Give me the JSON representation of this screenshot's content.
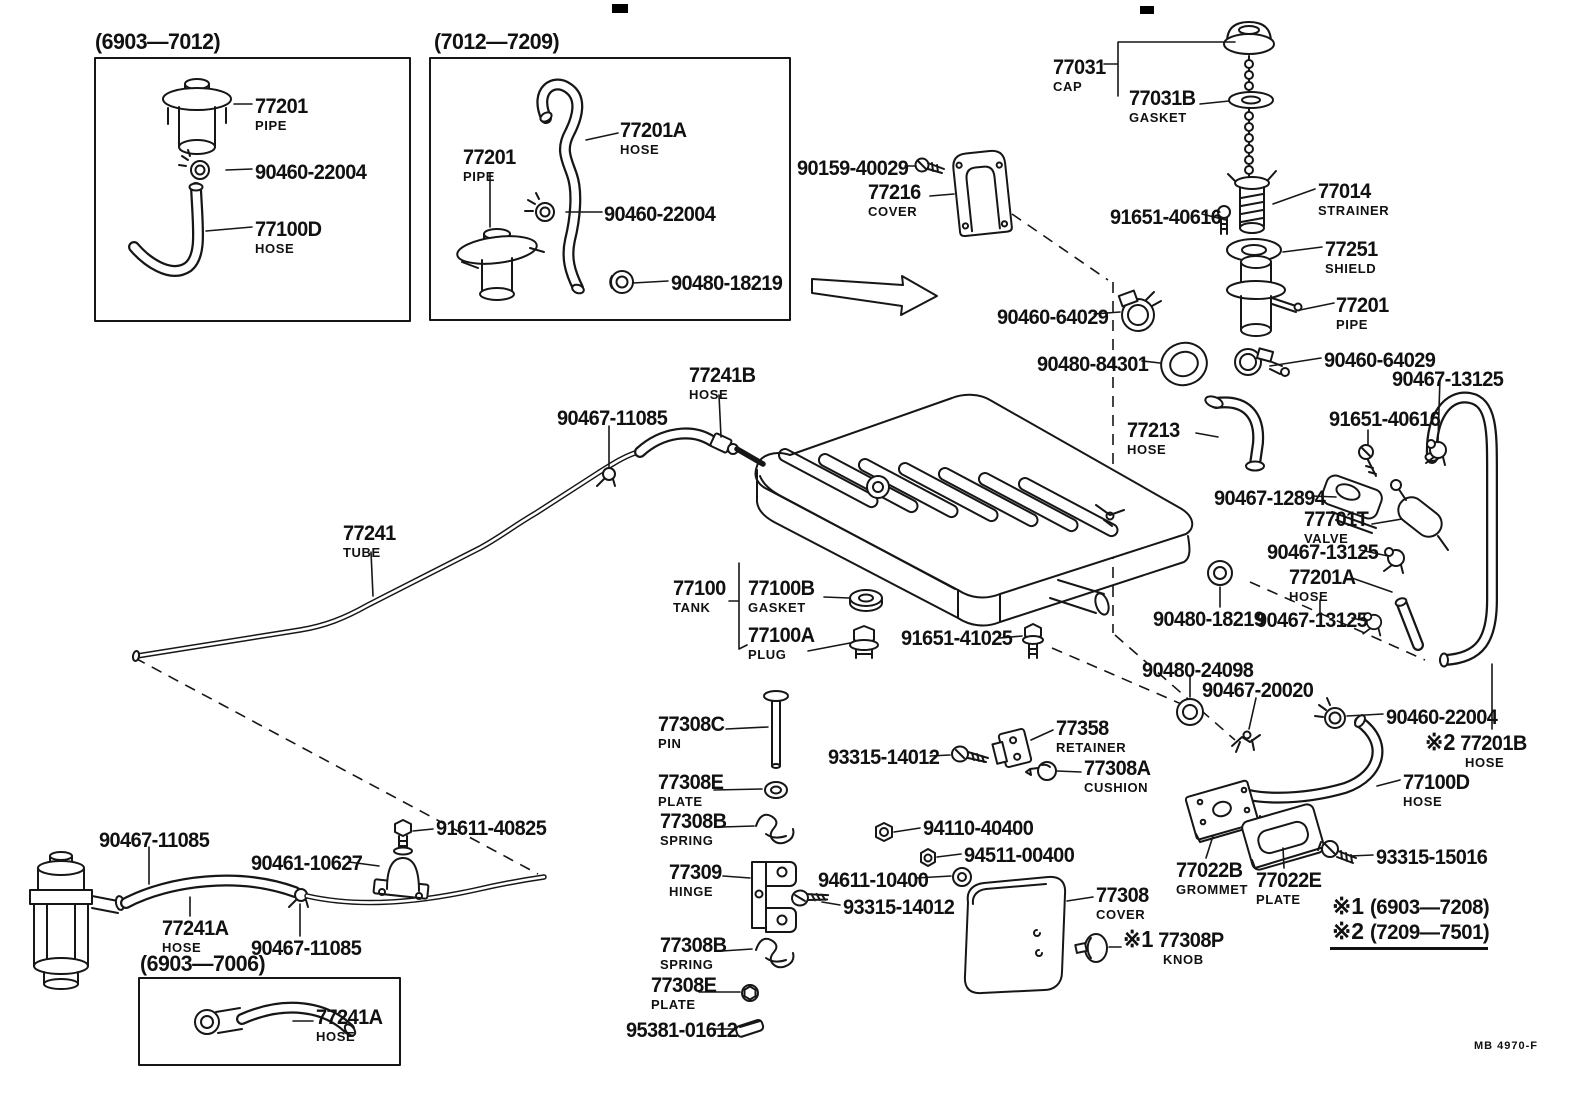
{
  "doc": {
    "stamp": "MB 4970-F"
  },
  "insets": {
    "a_period": "(6903—7012)",
    "b_period": "(7012—7209)",
    "c_period": "(6903—7006)"
  },
  "notes": {
    "n1_prefix": "※1",
    "n1_text": "(6903—7208)",
    "n2_prefix": "※2",
    "n2_text": "(7209—7501)"
  },
  "callouts": [
    {
      "id": "pipe-early",
      "code": "77201",
      "name": "PIPE",
      "x": 255,
      "y": 96
    },
    {
      "id": "clamp-early",
      "code": "90460-22004",
      "x": 255,
      "y": 162
    },
    {
      "id": "hose-early",
      "code": "77100D",
      "name": "HOSE",
      "x": 255,
      "y": 219
    },
    {
      "id": "hose-mid",
      "code": "77201A",
      "name": "HOSE",
      "x": 620,
      "y": 120
    },
    {
      "id": "pipe-mid",
      "code": "77201",
      "name": "PIPE",
      "x": 463,
      "y": 147
    },
    {
      "id": "clamp-mid",
      "code": "90460-22004",
      "x": 604,
      "y": 204
    },
    {
      "id": "grommet-mid",
      "code": "90480-18219",
      "x": 671,
      "y": 273
    },
    {
      "id": "fuel-cap",
      "code": "77031",
      "name": "CAP",
      "x": 1053,
      "y": 57
    },
    {
      "id": "cap-gasket",
      "code": "77031B",
      "name": "GASKET",
      "x": 1129,
      "y": 88
    },
    {
      "id": "screw-cover",
      "code": "90159-40029",
      "x": 797,
      "y": 158
    },
    {
      "id": "filler-cover",
      "code": "77216",
      "name": "COVER",
      "x": 868,
      "y": 182
    },
    {
      "id": "strainer",
      "code": "77014",
      "name": "STRAINER",
      "x": 1318,
      "y": 181
    },
    {
      "id": "bolt-strainer",
      "code": "91651-40616",
      "x": 1110,
      "y": 207
    },
    {
      "id": "shield",
      "code": "77251",
      "name": "SHIELD",
      "x": 1325,
      "y": 239
    },
    {
      "id": "pipe-tank",
      "code": "77201",
      "name": "PIPE",
      "x": 1336,
      "y": 295
    },
    {
      "id": "clamp-filler-left",
      "code": "90460-64029",
      "x": 997,
      "y": 307
    },
    {
      "id": "ring-filler",
      "code": "90480-84301",
      "x": 1037,
      "y": 354
    },
    {
      "id": "clamp-filler-right",
      "code": "90460-64029",
      "x": 1324,
      "y": 350
    },
    {
      "id": "clip-top",
      "code": "90467-13125",
      "x": 1392,
      "y": 369
    },
    {
      "id": "bolt-valve",
      "code": "91651-40616",
      "x": 1329,
      "y": 409
    },
    {
      "id": "filler-hose",
      "code": "77213",
      "name": "HOSE",
      "x": 1127,
      "y": 420
    },
    {
      "id": "valve-retainer",
      "code": "90467-12894",
      "x": 1214,
      "y": 488
    },
    {
      "id": "check-valve",
      "code": "77701T",
      "name": "VALVE",
      "x": 1304,
      "y": 509
    },
    {
      "id": "clip-mid",
      "code": "90467-13125",
      "x": 1267,
      "y": 542
    },
    {
      "id": "valve-hose",
      "code": "77201A",
      "name": "HOSE",
      "x": 1289,
      "y": 567
    },
    {
      "id": "grommet-tank",
      "code": "90480-18219",
      "x": 1153,
      "y": 609
    },
    {
      "id": "clip-low",
      "code": "90467-13125",
      "x": 1256,
      "y": 610
    },
    {
      "id": "grommet-breather",
      "code": "90480-24098",
      "x": 1142,
      "y": 660
    },
    {
      "id": "clip-breather",
      "code": "90467-20020",
      "x": 1202,
      "y": 680
    },
    {
      "id": "clamp-breather",
      "code": "90460-22004",
      "x": 1386,
      "y": 707
    },
    {
      "id": "hose-late",
      "prefix": "※2",
      "code": "77201B",
      "name": "HOSE",
      "x": 1425,
      "y": 731
    },
    {
      "id": "hose-bottom",
      "code": "77100D",
      "name": "HOSE",
      "x": 1403,
      "y": 772
    },
    {
      "id": "grommet-plate",
      "code": "77022B",
      "name": "GROMMET",
      "x": 1176,
      "y": 860
    },
    {
      "id": "plate-grommet",
      "code": "77022E",
      "name": "PLATE",
      "x": 1256,
      "y": 870
    },
    {
      "id": "screw-plate",
      "code": "93315-15016",
      "x": 1376,
      "y": 847
    },
    {
      "id": "tube-hose",
      "code": "77241B",
      "name": "HOSE",
      "x": 689,
      "y": 365
    },
    {
      "id": "clip-tube",
      "code": "90467-11085",
      "x": 557,
      "y": 408
    },
    {
      "id": "fuel-tube",
      "code": "77241",
      "name": "TUBE",
      "x": 343,
      "y": 523
    },
    {
      "id": "fuel-tank",
      "code": "77100",
      "name": "TANK",
      "x": 673,
      "y": 578
    },
    {
      "id": "tank-gasket",
      "code": "77100B",
      "name": "GASKET",
      "x": 748,
      "y": 578
    },
    {
      "id": "tank-plug",
      "code": "77100A",
      "name": "PLUG",
      "x": 748,
      "y": 625
    },
    {
      "id": "drain-bolt",
      "code": "91651-41025",
      "x": 901,
      "y": 628
    },
    {
      "id": "cover-pin",
      "code": "77308C",
      "name": "PIN",
      "x": 658,
      "y": 714
    },
    {
      "id": "cover-plate-1",
      "code": "77308E",
      "name": "PLATE",
      "x": 658,
      "y": 772
    },
    {
      "id": "cover-spring-1",
      "code": "77308B",
      "name": "SPRING",
      "x": 660,
      "y": 811
    },
    {
      "id": "screw-retainer",
      "code": "93315-14012",
      "x": 828,
      "y": 747
    },
    {
      "id": "cover-retainer",
      "code": "77358",
      "name": "RETAINER",
      "x": 1056,
      "y": 718
    },
    {
      "id": "cover-cushion",
      "code": "77308A",
      "name": "CUSHION",
      "x": 1084,
      "y": 758
    },
    {
      "id": "nut-1",
      "code": "94110-40400",
      "x": 923,
      "y": 818
    },
    {
      "id": "nut-2",
      "code": "94511-00400",
      "x": 964,
      "y": 845
    },
    {
      "id": "washer",
      "code": "94611-10400",
      "x": 818,
      "y": 870
    },
    {
      "id": "cover-hinge",
      "code": "77309",
      "name": "HINGE",
      "x": 669,
      "y": 862
    },
    {
      "id": "screw-hinge",
      "code": "93315-14012",
      "x": 843,
      "y": 897
    },
    {
      "id": "filler-lid",
      "code": "77308",
      "name": "COVER",
      "x": 1096,
      "y": 885
    },
    {
      "id": "lid-knob",
      "prefix": "※1",
      "code": "77308P",
      "name": "KNOB",
      "x": 1123,
      "y": 928
    },
    {
      "id": "cover-spring-2",
      "code": "77308B",
      "name": "SPRING",
      "x": 660,
      "y": 935
    },
    {
      "id": "cover-plate-2",
      "code": "77308E",
      "name": "PLATE",
      "x": 651,
      "y": 975
    },
    {
      "id": "cover-clip",
      "code": "95381-01612",
      "x": 626,
      "y": 1020
    },
    {
      "id": "clip-hose-a",
      "code": "90467-11085",
      "x": 99,
      "y": 830
    },
    {
      "id": "bracket-bolt",
      "code": "91611-40825",
      "x": 436,
      "y": 818
    },
    {
      "id": "tube-bracket",
      "code": "90461-10627",
      "x": 251,
      "y": 853
    },
    {
      "id": "filter-hose",
      "code": "77241A",
      "name": "HOSE",
      "x": 162,
      "y": 918
    },
    {
      "id": "clip-hose-b",
      "code": "90467-11085",
      "x": 251,
      "y": 938
    },
    {
      "id": "filter-hose-early",
      "code": "77241A",
      "name": "HOSE",
      "x": 316,
      "y": 1007
    }
  ]
}
